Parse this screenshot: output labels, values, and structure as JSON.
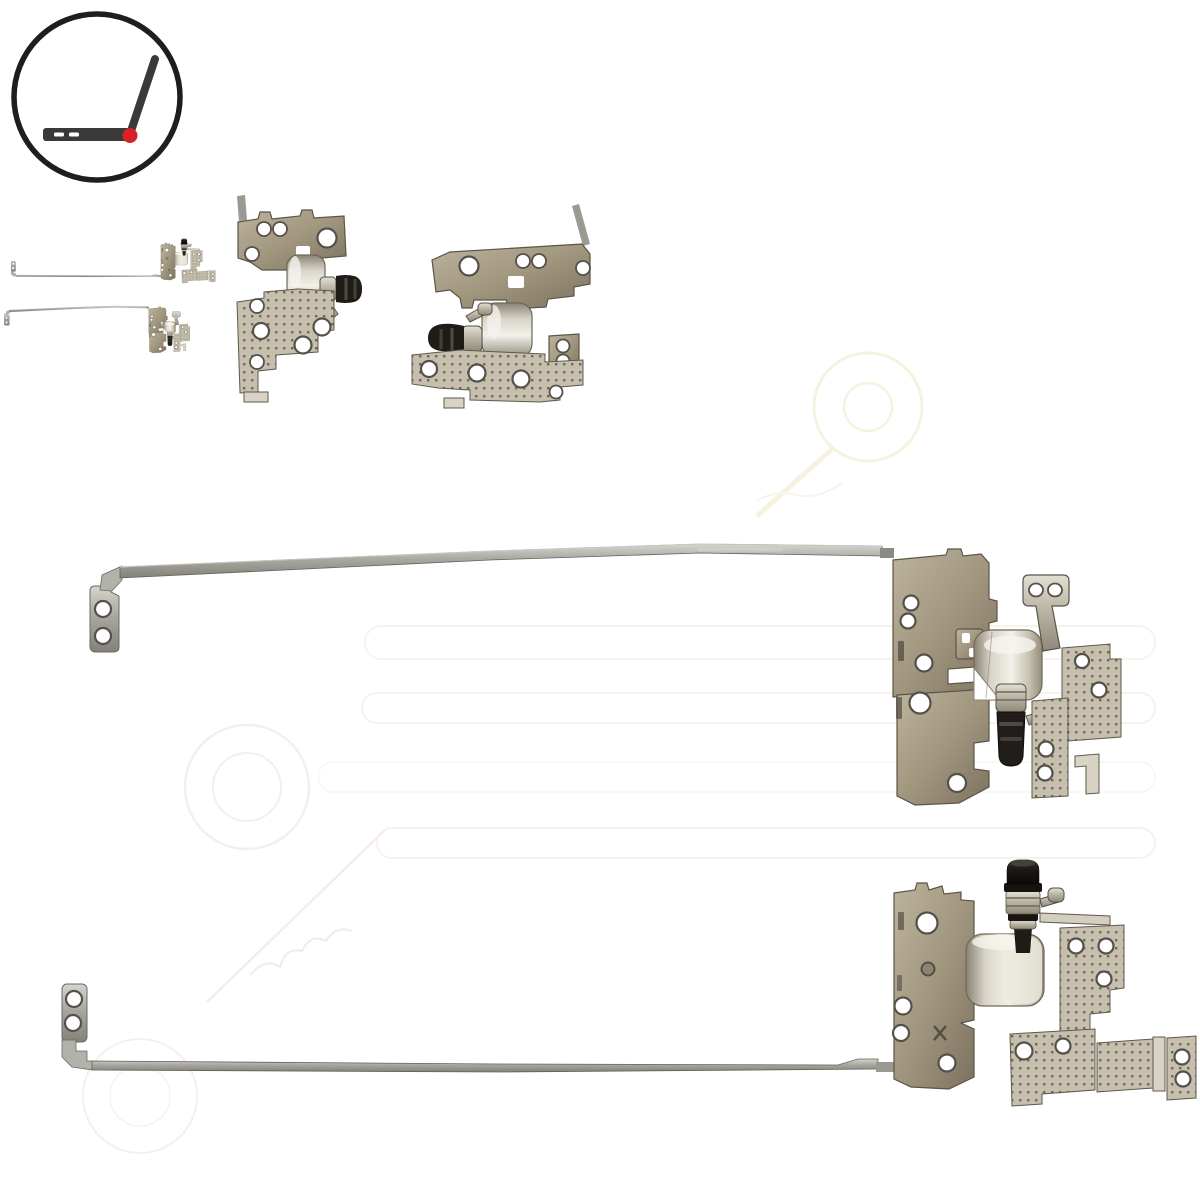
{
  "page": {
    "content_type": "product-photo-composite",
    "subject": "laptop-lcd-hinge-pair-left-and-right-rails",
    "visible_text": ""
  },
  "logo": {
    "icon": "open-laptop-hinge-icon",
    "ring_color": "#1e1e1c",
    "laptop_color": "#3a3a38",
    "hinge_dot_color": "#d7222a",
    "keyboard_dash_color": "#ffffff"
  },
  "gallery": {
    "thumbnails": [
      {
        "id": "pair-overview",
        "icon": "hinge-pair-mini-thumbnail"
      },
      {
        "id": "hinge-closeup-pin-right",
        "icon": "hinge-closeup-thumbnail"
      },
      {
        "id": "hinge-closeup-pin-left",
        "icon": "hinge-closeup-thumbnail-mirrored"
      }
    ]
  },
  "main_photos": [
    {
      "id": "top-hinge-rail",
      "parts": [
        "mounting-tab-two-holes",
        "long-support-rail",
        "stamped-hinge-bracket",
        "hinge-barrel",
        "hinge-pin-pointing-down",
        "l-bracket-two-holes",
        "perforated-mounting-plate"
      ]
    },
    {
      "id": "bottom-hinge-rail",
      "parts": [
        "mounting-tab-two-holes",
        "long-support-rail",
        "stamped-hinge-bracket",
        "hinge-barrel",
        "hinge-pin-pointing-up",
        "perforated-mounting-plates"
      ]
    }
  ],
  "watermark": {
    "shapes": [
      "double-ring-circle",
      "rounded-bar-outlines",
      "diagonal-stroke",
      "script-squiggle"
    ],
    "circle_positions": [
      "top-right",
      "mid-left",
      "bottom-left"
    ]
  },
  "colors": {
    "background": "#ffffff",
    "rail_metal": "#a9a8a0",
    "rail_edge": "#63625a",
    "bronze_metal": "#a1967e",
    "bronze_edge": "#5c5546",
    "plate_metal": "#c6bfae",
    "plate_dot": "#6f6757",
    "plate_edge": "#5f594b",
    "barrel_highlight": "#f2f1ea",
    "pin_black": "#1f1c18",
    "silver_metal": "#cdc7b8",
    "hole_rim": "#55504a",
    "watermark_pink": "#f6eeee",
    "watermark_cream": "#f6f2e0"
  }
}
